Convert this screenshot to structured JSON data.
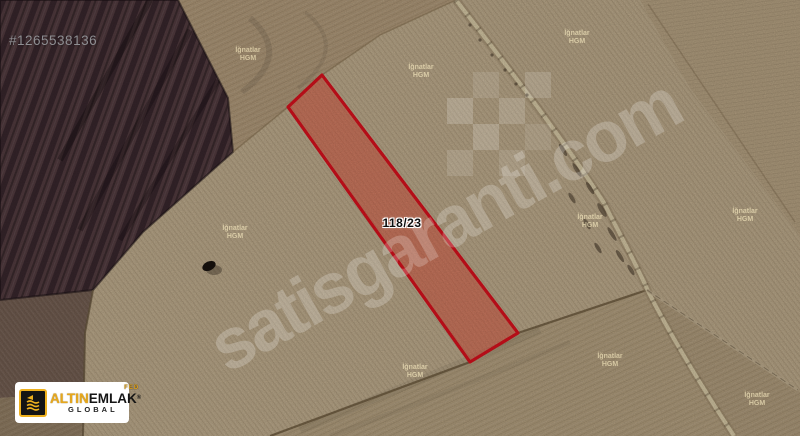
{
  "photo_id": "#1265538136",
  "parcel": {
    "label": "118/23"
  },
  "map_watermark": {
    "line1": "İğnatlar",
    "line2": "HGM",
    "positions": [
      {
        "x": 248,
        "y": 55
      },
      {
        "x": 421,
        "y": 72
      },
      {
        "x": 577,
        "y": 38
      },
      {
        "x": 235,
        "y": 233
      },
      {
        "x": 590,
        "y": 222
      },
      {
        "x": 745,
        "y": 216
      },
      {
        "x": 415,
        "y": 372
      },
      {
        "x": 610,
        "y": 361
      },
      {
        "x": 757,
        "y": 400
      }
    ]
  },
  "site_watermark": {
    "text": "satisgaranti.com"
  },
  "logo": {
    "part1": "ALTIN",
    "part2": "EMLAK",
    "registered": "®",
    "fed": "FED",
    "subtitle": "GLOBAL"
  },
  "colors": {
    "parcel_fill": "#d74a38",
    "parcel_border": "#d0101c",
    "logo_gold": "#edb01e"
  }
}
